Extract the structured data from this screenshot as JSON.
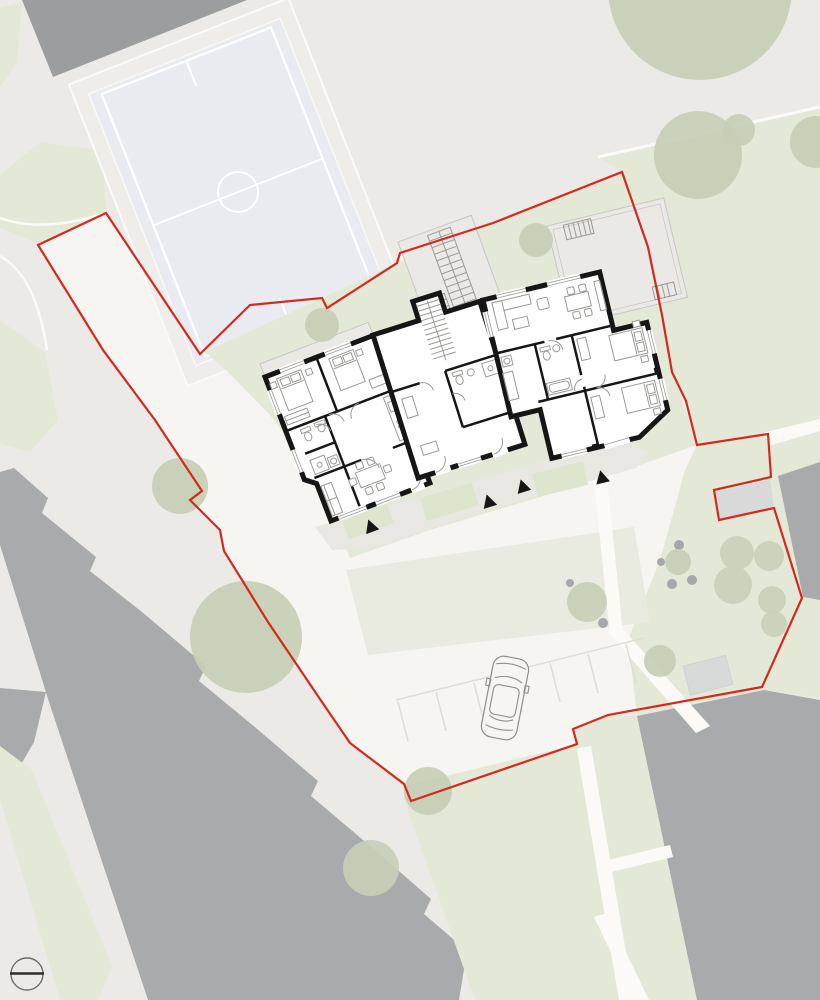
{
  "document": {
    "kind": "architectural-site-plan",
    "view": "ground-floor site plan with context",
    "canvas": {
      "width_px": 820,
      "height_px": 1000
    },
    "text_labels": []
  },
  "colors": {
    "bg": "#eceae6",
    "paved": "#f6f5f1",
    "lawn": "#e4e9d7",
    "lawn-pale": "#e9ebe0",
    "patio": "#dde6cd",
    "shade": "#e9e7e1",
    "field": "#e9ebf1",
    "field-line": "#ffffff",
    "tree": "#c6cfb6",
    "shrub": "#c9d2ba",
    "wall": "#161616",
    "room": "#ffffff",
    "furniture": "#9a9a96",
    "slab": "#a8aaab",
    "slab-dark": "#9b9d9f",
    "slab-light": "#d8d9d9",
    "terrace": "#eae9e6",
    "terrace-line": "#c8c7c4",
    "red": "#d4291f",
    "path-white": "#fbfaf7",
    "parking-line": "#dfdcd6",
    "marker": "#6b6b68",
    "car-line": "#8e8e8a",
    "dot": "#a6a7a8"
  },
  "site": {
    "boundary": {
      "style": "solid",
      "color_ref": "red",
      "closed": true
    },
    "building": {
      "wings": 3,
      "entrance_arrow_count": 4,
      "stair_flights": 3,
      "roof_terraces": 2
    },
    "sports_field": {
      "center_circle": true,
      "center_line": true,
      "goal_marks": 2,
      "markings_color_ref": "field-line"
    },
    "vegetation": {
      "tree_count": 13,
      "shrub_count": 5
    },
    "vehicles": {
      "car_count": 1
    },
    "parking": {
      "stall_line_count": 7
    },
    "symbols": [
      {
        "name": "entrance-arrow",
        "shape": "black triangle"
      },
      {
        "name": "survey-marker",
        "shape": "circle with horizontal line"
      }
    ],
    "neighbour_buildings": {
      "count": 4
    }
  }
}
